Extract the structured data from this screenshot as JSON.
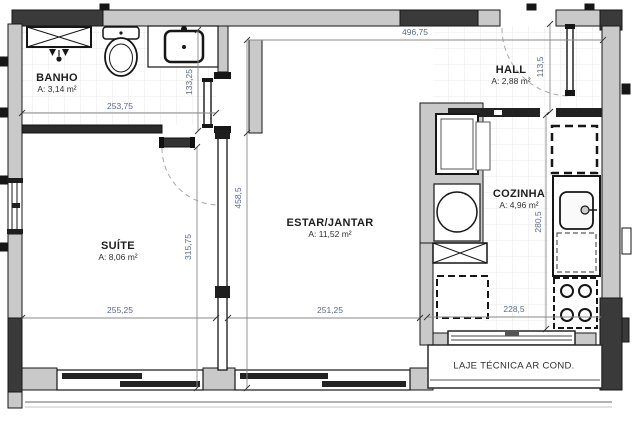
{
  "title": "apartment floor plan",
  "rooms": [
    {
      "id": "banho",
      "name": "BANHO",
      "area": "A: 3,14 m²"
    },
    {
      "id": "suite",
      "name": "SUÍTE",
      "area": "A: 8,06 m²"
    },
    {
      "id": "estar_jantar",
      "name": "ESTAR/JANTAR",
      "area": "A: 11,52 m²"
    },
    {
      "id": "hall",
      "name": "HALL",
      "area": "A: 2,88 m²"
    },
    {
      "id": "cozinha",
      "name": "COZINHA",
      "area": "A: 4,96 m²"
    }
  ],
  "annotations": {
    "laje_tecnica": "LAJE TÉCNICA AR COND."
  },
  "dimensions": {
    "top_width": "496,75",
    "banho_width": "253,75",
    "banho_depth": "133,25",
    "hall_depth": "113,5",
    "estar_height": "458,5",
    "suite_height": "315,75",
    "cozinha_height": "280,5",
    "suite_width": "255,25",
    "estar_width": "251,25",
    "cozinha_width": "228,5"
  },
  "colors": {
    "wall_light": "#c9c9c9",
    "wall_dark": "#3a3a3a",
    "line": "#161616",
    "dim_line": "#8a8a8a",
    "dim_text": "#5b6b83",
    "floor_grid": "#e9e9e9",
    "background": "#ffffff"
  }
}
